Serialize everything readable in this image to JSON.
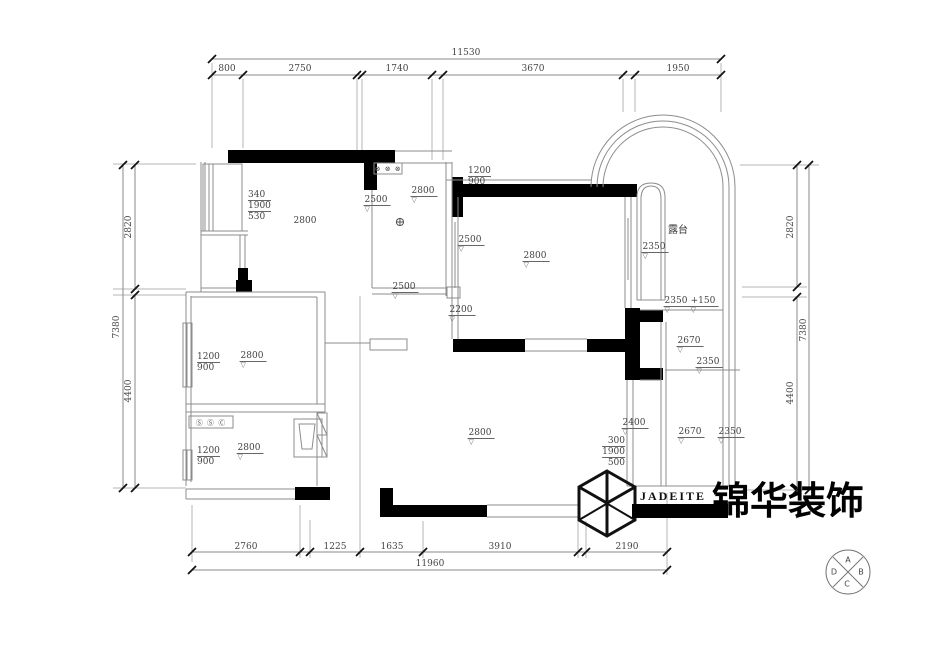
{
  "dims": {
    "top": {
      "overall": "11530",
      "s": [
        "800",
        "2750",
        "1740",
        "3670",
        "1950"
      ]
    },
    "bottom": {
      "overall": "11960",
      "s": [
        "2760",
        "1225",
        "1635",
        "3910",
        "2190"
      ]
    },
    "left": {
      "overall": "7380",
      "s": [
        "2820",
        "4400"
      ]
    },
    "right": {
      "overall": "7380",
      "s": [
        "2820",
        "4400"
      ]
    }
  },
  "rooms": {
    "top_left": {
      "stack": [
        "340",
        "1900",
        "530"
      ],
      "height": "2800"
    },
    "bath": {
      "switches": "⊗ ⊗ ⊗",
      "left": "2500",
      "top": "2800",
      "bottom": "2500",
      "ceiling": "⊕"
    },
    "bedroom_right": {
      "above": [
        "1200",
        "900"
      ],
      "left_upper": "2500",
      "left_lower": "2200",
      "height": "2800"
    },
    "terrace": {
      "name": "露台",
      "height": "2350",
      "lower": "2350",
      "level": "+150"
    },
    "right_mid": {
      "height": "2670",
      "sub": "2350"
    },
    "right_bottom": {
      "left": "2400",
      "stack": [
        "300",
        "1900",
        "500"
      ],
      "height": "2670",
      "right": "2350"
    },
    "mid_left": {
      "stack": [
        "1200",
        "900"
      ],
      "height": "2800"
    },
    "kitchen": {
      "switches": "Ⓢ Ⓢ Ⓒ",
      "stack": [
        "1200",
        "900"
      ],
      "height": "2800"
    },
    "living": {
      "height": "2800"
    }
  },
  "symbols": {
    "level": "▽"
  },
  "colors": {
    "wall": "#000000",
    "line": "#8c8c8c",
    "text": "#444444"
  },
  "logo": {
    "brand": "JADEITE",
    "cn": "锦华装饰"
  },
  "compass": {
    "n": "A",
    "e": "B",
    "s": "C",
    "w": "D"
  }
}
